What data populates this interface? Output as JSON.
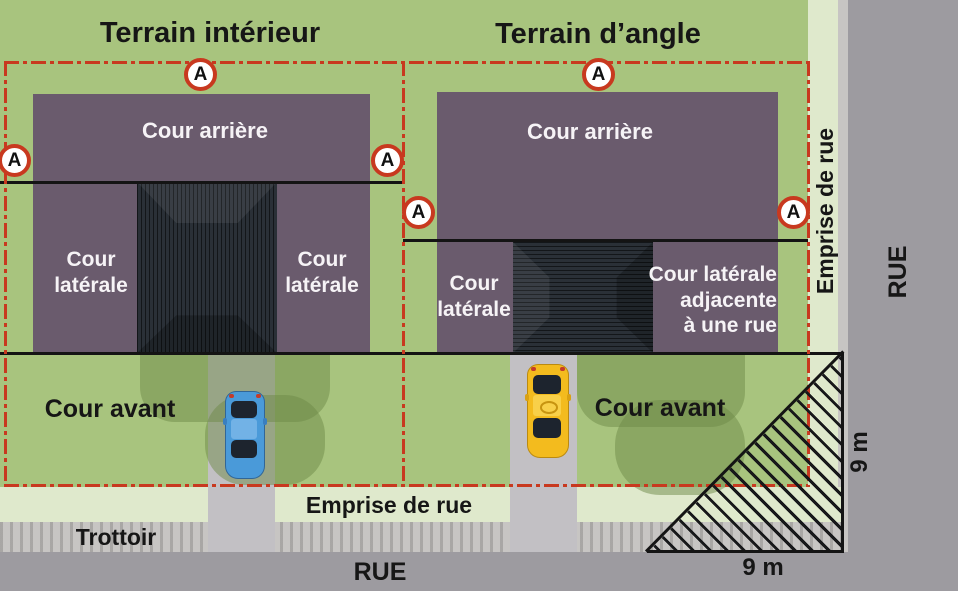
{
  "titles": {
    "interior_lot": "Terrain intérieur",
    "corner_lot": "Terrain d’angle"
  },
  "marker": {
    "letter": "A"
  },
  "yards": {
    "rear_left_lot": "Cour arrière",
    "rear_right_lot": "Cour arrière",
    "side_left_outer": "Cour\nlatérale",
    "side_left_inner": "Cour\nlatérale",
    "side_right_inner": "Cour\nlatérale",
    "side_right_street": "Cour latérale\nadjacente\nà une rue",
    "front_left_lot": "Cour avant",
    "front_right_lot": "Cour avant"
  },
  "streets": {
    "right_of_way_bottom": "Emprise de rue",
    "right_of_way_side": "Emprise de rue",
    "sidewalk": "Trottoir",
    "street_bottom": "RUE",
    "street_side": "RUE"
  },
  "dimensions": {
    "corner_width": "9 m",
    "corner_height": "9 m"
  },
  "colors": {
    "lawn": "#a8c47e",
    "shadow": "#6d8a48",
    "pale": "#dfe9cc",
    "sidewalk": "#c7c5c3",
    "street": "#9d9ba0",
    "driveway": "#c2c0c4",
    "purple": "#6a5b6d",
    "roof": "#2a3037",
    "red": "#c8391f",
    "car_blue": "#4a9ad9",
    "car_yellow": "#f3bb1e"
  }
}
